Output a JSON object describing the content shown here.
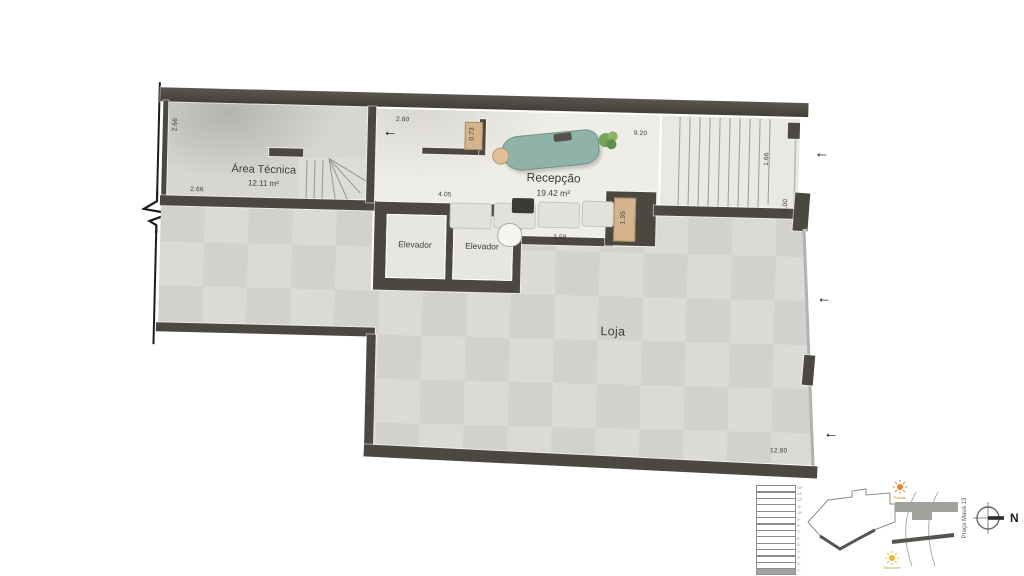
{
  "plan": {
    "rooms": {
      "area_tecnica": {
        "name": "Área Técnica",
        "area": "12.11 m²"
      },
      "recepcao": {
        "name": "Recepção",
        "area": "19.42 m²"
      },
      "elevador_1": {
        "name": "Elevador"
      },
      "elevador_2": {
        "name": "Elevador"
      },
      "loja": {
        "name": "Loja"
      }
    },
    "dimensions": {
      "at_left": "2.66",
      "at_bottom": "2.66",
      "entry": "2.80",
      "bench": "0.73",
      "stair_run": "9.20",
      "stair_width": "1.66",
      "right_wall": "6.00",
      "elevator_width": "4.05",
      "desk": "3.58",
      "niche": "1.35",
      "storefront": "12.80"
    }
  },
  "icons": {
    "entry_arrow": "←"
  },
  "legend": {
    "floors": [
      "14º",
      "13º",
      "12º",
      "11º",
      "10º",
      "9º",
      "8º",
      "7º",
      "6º",
      "5º",
      "4º",
      "3º",
      "2º",
      "1º"
    ],
    "key_plan_street": "Praça Mauá 13",
    "sun_top": "Poente",
    "sun_bottom": "Nascente",
    "north_label": "N"
  },
  "colors": {
    "wall": "#4b4741",
    "loja_floor": "#d7d6d2",
    "reception_floor": "#efede7",
    "desk_teal": "#8fb3a8",
    "wood": "#d4b48c",
    "unit_highlight": "#a2a19e"
  }
}
